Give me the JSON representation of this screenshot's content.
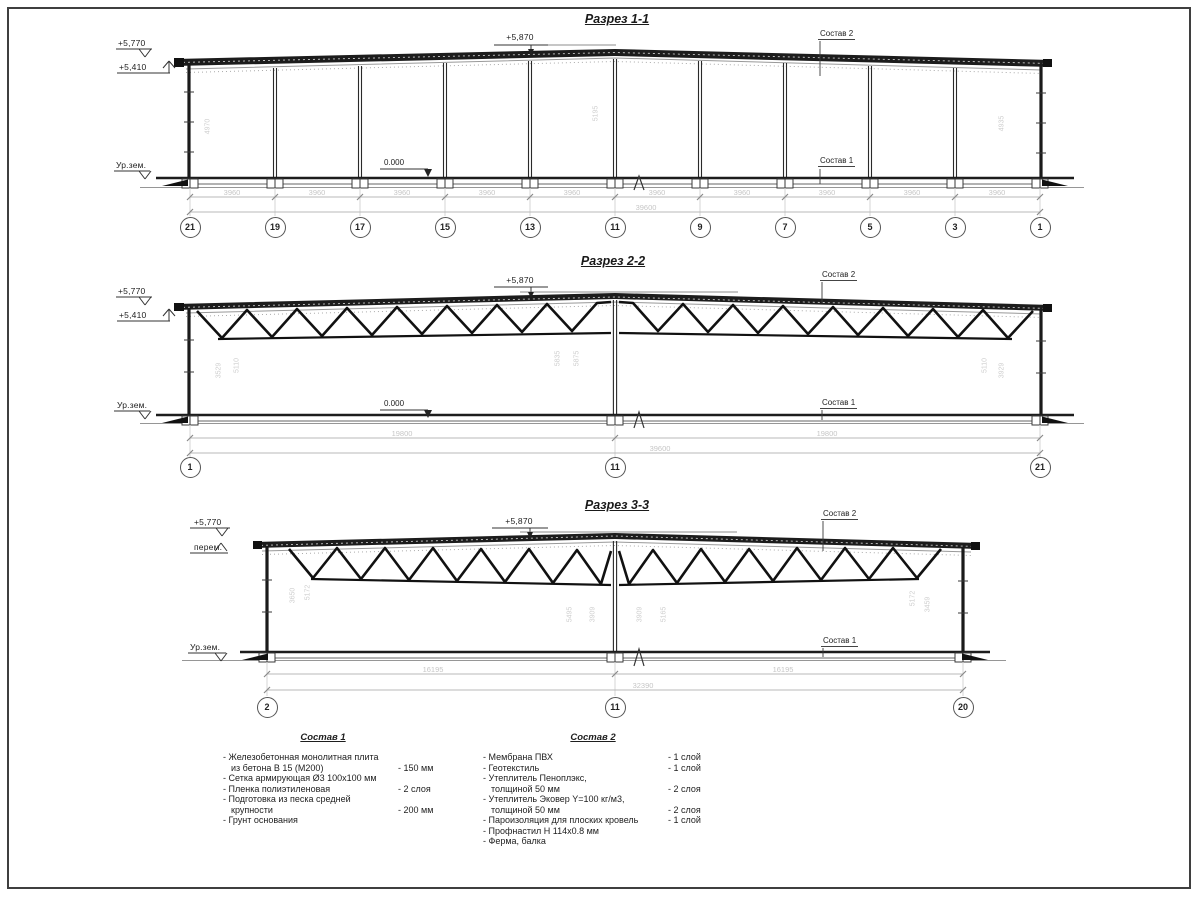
{
  "s1": {
    "title": "Разрез 1-1",
    "elev_eave": "+5,770",
    "elev_soffit": "+5,410",
    "elev_ridge": "+5,870",
    "ground_label": "Ур.зем.",
    "zero_mark": "0.000",
    "layer_top_label": "Состав 2",
    "layer_bottom_label": "Состав 1",
    "bay_dims": [
      "3960",
      "3960",
      "3960",
      "3960",
      "3960",
      "3960",
      "3960",
      "3960",
      "3960",
      "3960"
    ],
    "total_dim": "39600",
    "axes": [
      "21",
      "19",
      "17",
      "15",
      "13",
      "11",
      "9",
      "7",
      "5",
      "3",
      "1"
    ],
    "vdims": [
      "4970",
      "5195",
      "4935"
    ]
  },
  "s2": {
    "title": "Разрез 2-2",
    "elev_eave": "+5,770",
    "elev_soffit": "+5,410",
    "elev_ridge": "+5,870",
    "ground_label": "Ур.зем.",
    "zero_mark": "0.000",
    "layer_top_label": "Состав 2",
    "layer_bottom_label": "Состав 1",
    "span_dims": [
      "19800",
      "19800"
    ],
    "total_dim": "39600",
    "axes": [
      "1",
      "11",
      "21"
    ],
    "vdims": [
      "3529",
      "5110",
      "5835",
      "5875",
      "5110",
      "3929"
    ]
  },
  "s3": {
    "title": "Разрез 3-3",
    "elev_eave": "+5,770",
    "elev_var": "перем.",
    "elev_ridge": "+5,870",
    "ground_label": "Ур.зем.",
    "layer_top_label": "Состав 2",
    "layer_bottom_label": "Состав 1",
    "span_dims": [
      "16195",
      "16195"
    ],
    "total_dim": "32390",
    "axes": [
      "2",
      "11",
      "20"
    ],
    "vdims": [
      "3650",
      "5172",
      "5495",
      "3909",
      "3909",
      "5165",
      "5172",
      "3459"
    ]
  },
  "legend1": {
    "title": "Состав 1",
    "rows": [
      {
        "l": "- Железобетонная  монолитная плита",
        "r": ""
      },
      {
        "l": "из бетона В 15 (М200)",
        "r": "- 150 мм"
      },
      {
        "l": "- Сетка армирующая Ø3 100х100 мм",
        "r": ""
      },
      {
        "l": "- Пленка полиэтиленовая",
        "r": "- 2 слоя"
      },
      {
        "l": "- Подготовка из песка средней",
        "r": ""
      },
      {
        "l": "крупности",
        "r": "- 200 мм"
      },
      {
        "l": "- Грунт основания",
        "r": ""
      }
    ]
  },
  "legend2": {
    "title": "Состав 2",
    "rows": [
      {
        "l": "- Мембрана ПВХ",
        "r": "- 1 слой"
      },
      {
        "l": "- Геотекстиль",
        "r": "- 1 слой"
      },
      {
        "l": "- Утеплитель Пеноплэкс,",
        "r": ""
      },
      {
        "l": "толщиной 50 мм",
        "r": "- 2 слоя"
      },
      {
        "l": "- Утеплитель Эковер Y=100 кг/м3,",
        "r": ""
      },
      {
        "l": "толщиной 50 мм",
        "r": "- 2 слоя"
      },
      {
        "l": "- Пароизоляция для плоских кровель",
        "r": "- 1 слой"
      },
      {
        "l": "- Профнастил Н 114х0.8 мм",
        "r": ""
      },
      {
        "l": "- Ферма, балка",
        "r": ""
      }
    ]
  }
}
